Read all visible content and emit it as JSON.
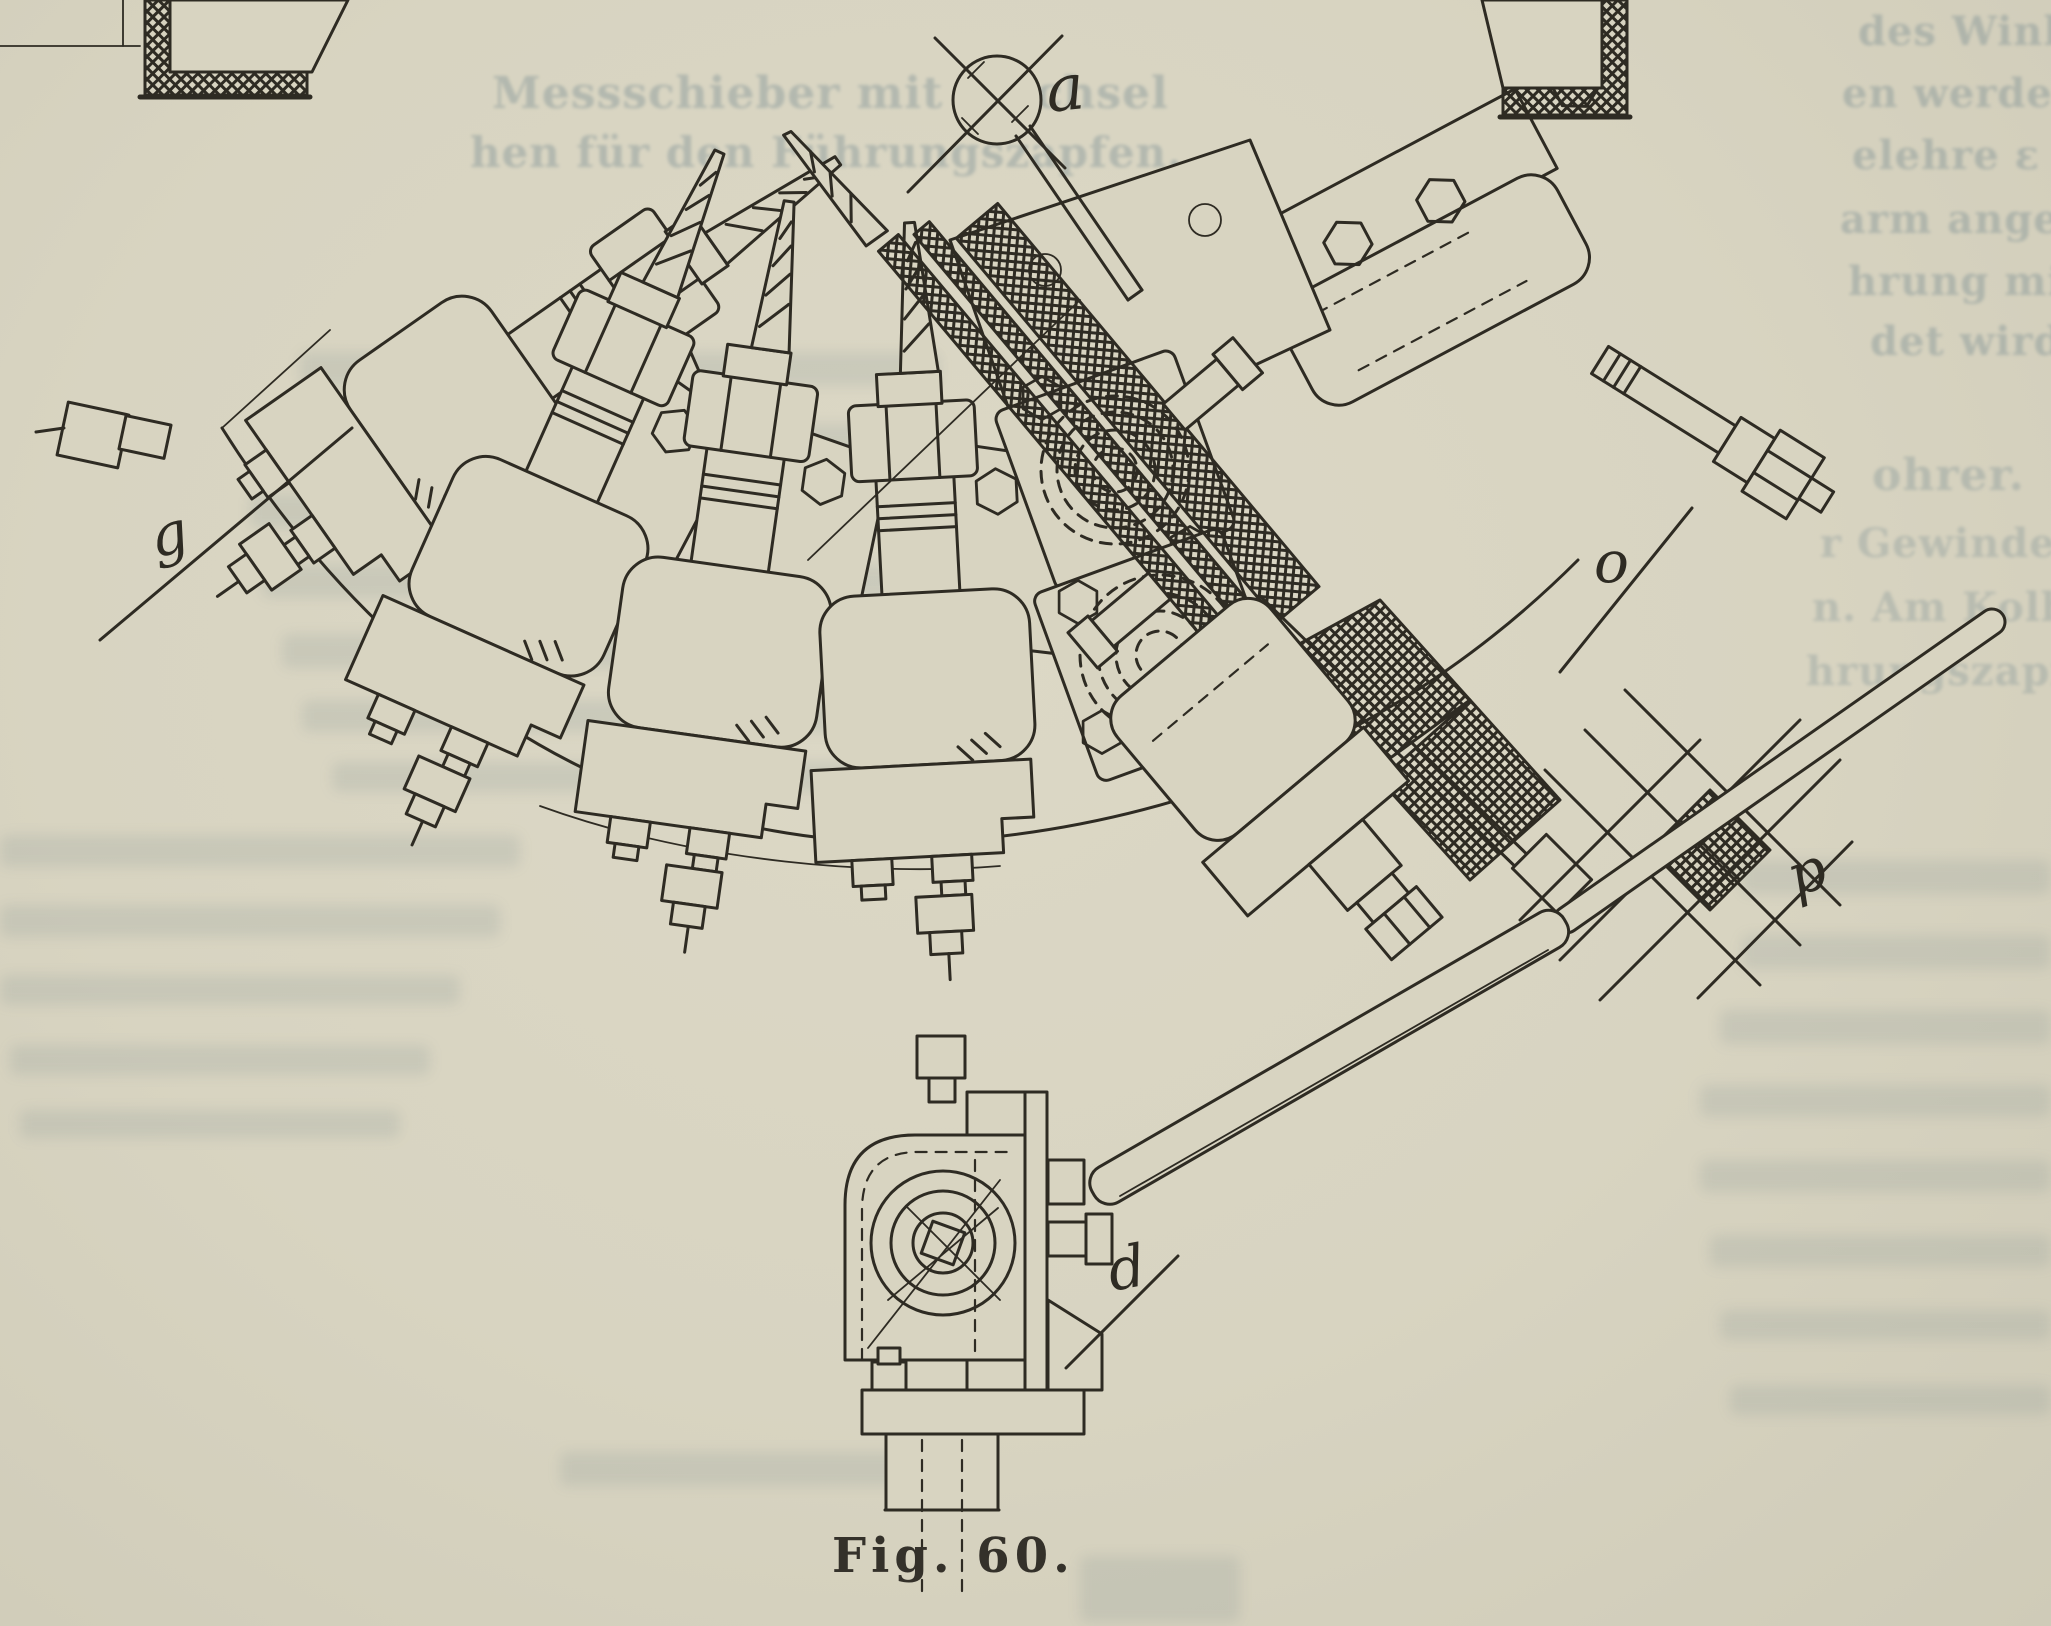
{
  "page": {
    "kind": "scanned-book-page",
    "background_color": "#d8d4c1",
    "ink_color": "#2e2b23",
    "ghost_ink_color": "#5d7884"
  },
  "figure": {
    "caption": "Fig. 60.",
    "part_labels": [
      {
        "id": "a"
      },
      {
        "id": "g"
      },
      {
        "id": "o"
      },
      {
        "id": "p"
      },
      {
        "id": "d"
      }
    ]
  },
  "ghost_text": {
    "heading": [
      "Messschieber mit Wechsel",
      "hen für den Führungszapfen."
    ],
    "right_top": [
      "des Winkel-",
      "en werden, so-",
      "elehre ε an",
      "arm angeschlo-",
      "hrung mit der",
      "det wird."
    ],
    "right_mid": [
      "ohrer.",
      "r Gewindeb",
      "n. Am Kolben",
      "hrungszapfen"
    ]
  }
}
